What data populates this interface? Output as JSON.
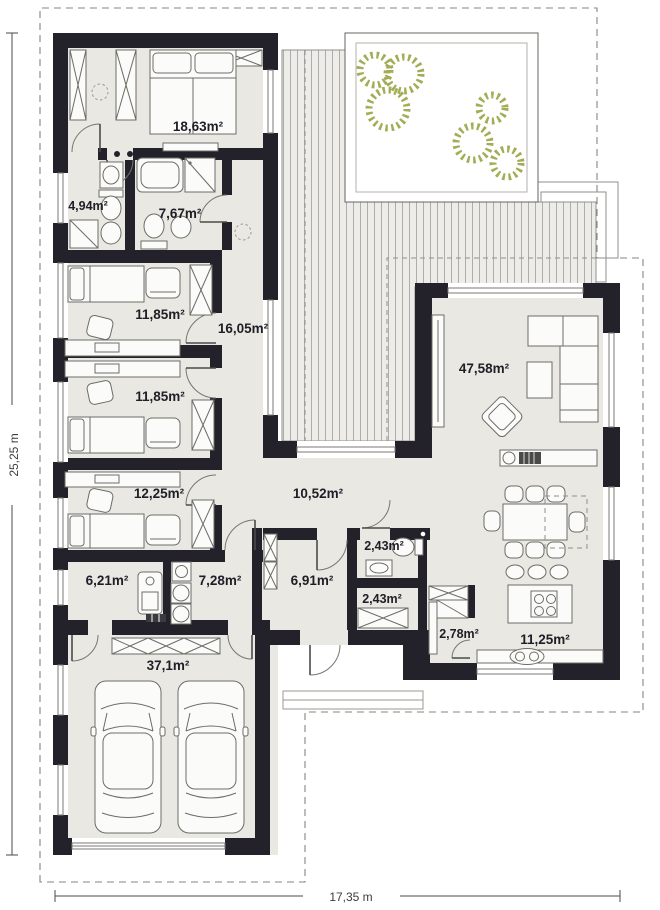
{
  "plan": {
    "rooms": [
      {
        "id": "main-bedroom",
        "area": "18,63m²"
      },
      {
        "id": "wc",
        "area": "4,94m²"
      },
      {
        "id": "bathroom",
        "area": "7,67m²"
      },
      {
        "id": "bedroom-1",
        "area": "11,85m²"
      },
      {
        "id": "hall",
        "area": "16,05m²"
      },
      {
        "id": "bedroom-2",
        "area": "11,85m²"
      },
      {
        "id": "bedroom-3",
        "area": "12,25m²"
      },
      {
        "id": "utility",
        "area": "6,21m²"
      },
      {
        "id": "laundry",
        "area": "7,28m²"
      },
      {
        "id": "garage",
        "area": "37,1m²"
      },
      {
        "id": "corridor",
        "area": "10,52m²"
      },
      {
        "id": "vestibule",
        "area": "6,91m²"
      },
      {
        "id": "toilet",
        "area": "2,43m²"
      },
      {
        "id": "closet",
        "area": "2,43m²"
      },
      {
        "id": "pantry",
        "area": "2,78m²"
      },
      {
        "id": "kitchen",
        "area": "11,25m²"
      },
      {
        "id": "living-room",
        "area": "47,58m²"
      }
    ],
    "dimensions": {
      "height": "25,25 m",
      "width": "17,35 m"
    },
    "colors": {
      "wall": "#23222a",
      "floor": "#e9e8e3",
      "terrace_bg": "#edece8",
      "terrace_line": "#adada9",
      "plant_green": "#a3ad56",
      "outline_gray": "#8f8f8b"
    }
  }
}
